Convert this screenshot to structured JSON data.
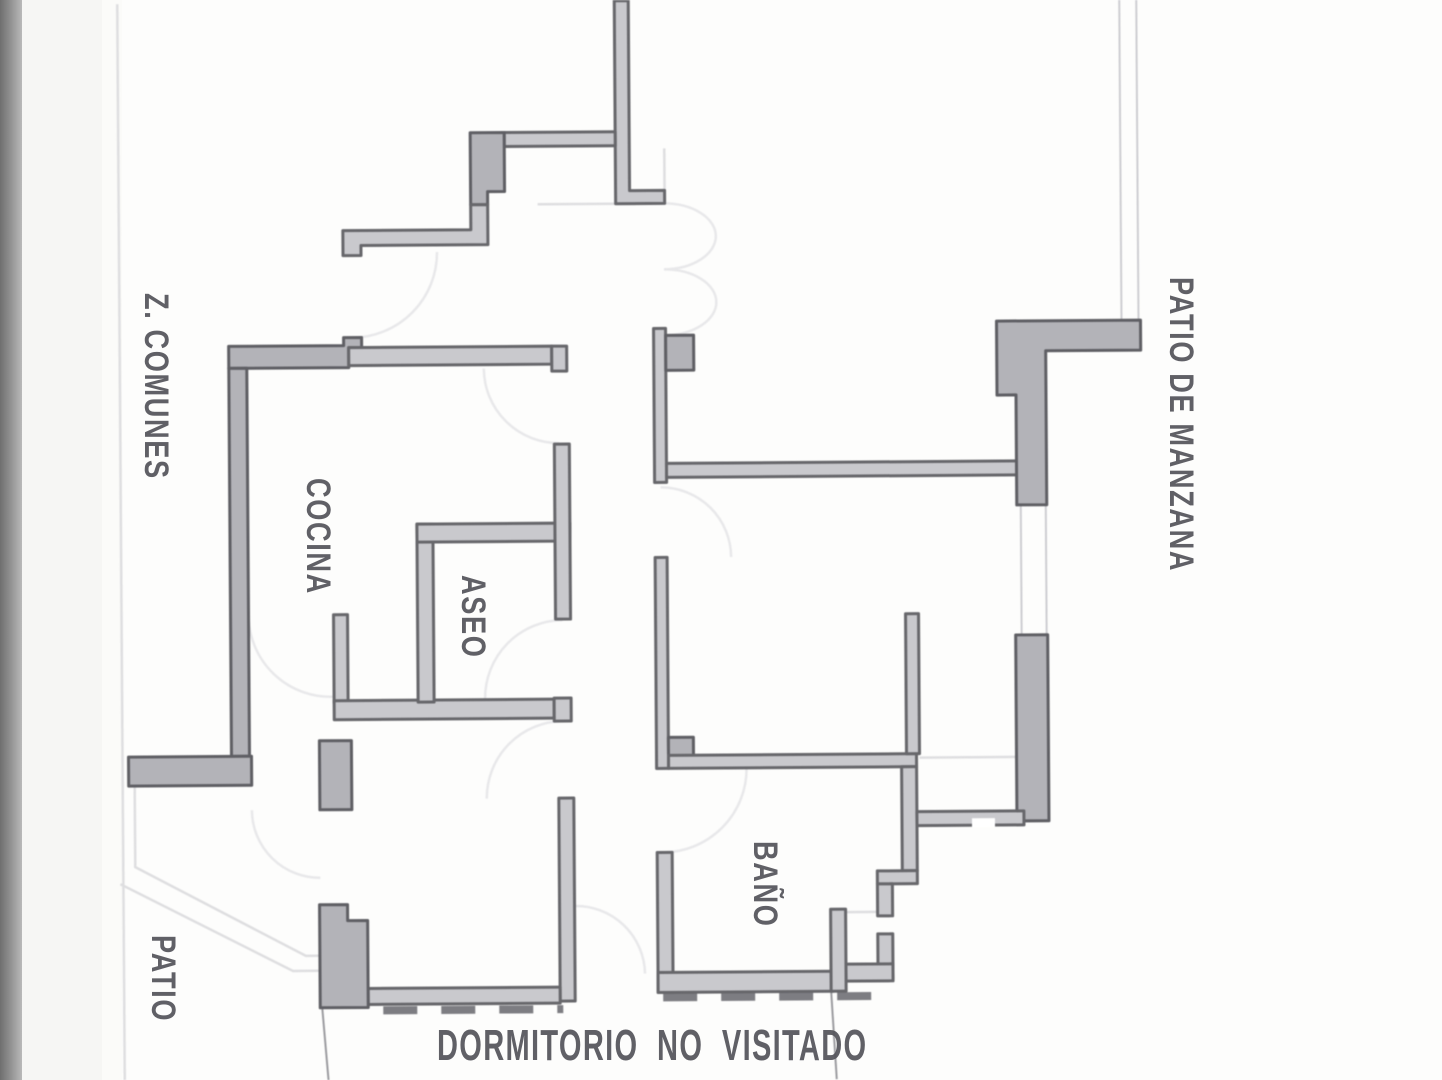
{
  "page": {
    "width": 1442,
    "height": 1080,
    "kind": "scanned architectural floor plan"
  },
  "colors": {
    "paper": "#fdfdfc",
    "scan_strip": "#8a8a8a",
    "wall_fill": "#c9c9cd",
    "wall_thick_fill": "#b3b3b8",
    "wall_stroke": "#67676b",
    "light_line": "#dedee0",
    "door_arc": "#e8e8ea",
    "text": "#53535a"
  },
  "labels": {
    "z_comunes": {
      "text": "Z. COMUNES",
      "x": 175,
      "y": 293,
      "orient": "v"
    },
    "patio_de_manzana": {
      "text": "PATIO DE MANZANA",
      "x": 1200,
      "y": 277,
      "orient": "v"
    },
    "cocina": {
      "text": "COCINA",
      "x": 337,
      "y": 478,
      "orient": "v"
    },
    "aseo": {
      "text": "ASEO",
      "x": 492,
      "y": 575,
      "orient": "v"
    },
    "bano": {
      "text": "BAÑO",
      "x": 784,
      "y": 841,
      "orient": "v"
    },
    "patio": {
      "text": "PATIO",
      "x": 182,
      "y": 935,
      "orient": "v"
    },
    "dormitorio_no_visitado": {
      "text": "DORMITORIO NO VISITADO",
      "x": 437,
      "y": 1021,
      "orient": "h"
    }
  },
  "geometry": {
    "lights": [
      {
        "name": "beam-line-hall-top",
        "d": "M540,203 L660,203"
      },
      {
        "name": "boundary-line-top",
        "d": "M667,148 L667,190"
      },
      {
        "name": "lintel-line-gallery",
        "d": "M918,759 L1018,759"
      },
      {
        "name": "lintel-line-bath-door",
        "d": "M843,913 L875,913"
      },
      {
        "name": "patio-boundary-1",
        "d": "M133,782 L133,863 L303,953 L317,953"
      },
      {
        "name": "patio-boundary-2",
        "d": "M118,880 L290,968 L317,968"
      },
      {
        "name": "page-edge-line",
        "d": "M121,0 L121,1080"
      }
    ],
    "openings": [
      {
        "name": "door-arc-entrance",
        "d": "M439,250 A85,85 0 0 1 354,335"
      },
      {
        "name": "door-arc-double-top",
        "d": "M666,203 A52,33 0 0 1 666,269"
      },
      {
        "name": "door-arc-double-bottom",
        "d": "M666,269 A52,33 0 0 1 666,335"
      },
      {
        "name": "door-arc-kitchen",
        "d": "M485,367 A75,75 0 0 0 560,442"
      },
      {
        "name": "door-arc-kitchen-lower",
        "d": "M248,612 A82,82 0 0 0 333,694"
      },
      {
        "name": "door-arc-hall",
        "d": "M661,487 A70,70 0 0 1 731,557"
      },
      {
        "name": "door-arc-aseo",
        "d": "M562,619 A78,78 0 0 0 484,697"
      },
      {
        "name": "door-arc-dormitorio",
        "d": "M485,797 A77,77 0 0 1 562,720"
      },
      {
        "name": "door-arc-bath-hall",
        "d": "M745,768 A84,84 0 0 1 661,852"
      },
      {
        "name": "door-arc-vestibule",
        "d": "M572,905 A69,69 0 0 1 642,973"
      },
      {
        "name": "door-arc-patio-kitchen",
        "d": "M250,807 A68,68 0 0 0 318,875"
      }
    ],
    "dashes": [
      {
        "name": "dashed-wall-dormitorio-left",
        "d": "M380,1008 L560,1008"
      },
      {
        "name": "dashed-wall-dormitorio-right",
        "d": "M660,997 L888,997"
      }
    ],
    "leaders": [
      {
        "name": "leader-line-left",
        "d": "M319,1005 L325,1080"
      },
      {
        "name": "leader-line-right",
        "d": "M828,992 L833,1080"
      }
    ],
    "windows": [
      {
        "name": "window-right-upper-a",
        "d": "M1021,505 L1021,639"
      },
      {
        "name": "window-right-upper-b",
        "d": "M1046,505 L1046,639"
      },
      {
        "name": "window-top-right-a",
        "d": "M1123,2 L1123,323"
      },
      {
        "name": "window-top-right-b",
        "d": "M1140,2 L1140,323"
      }
    ],
    "walls": [
      {
        "name": "wall-top-vertical",
        "cls": "wl",
        "d": "M618,0 L632,0 L632,190 L667,190 L667,203 L618,203 Z"
      },
      {
        "name": "wall-top-arm",
        "cls": "wl",
        "d": "M507,131 L618,131 L618,145 L507,145 Z"
      },
      {
        "name": "wall-top-pier",
        "cls": "wt",
        "d": "M473,131 L507,131 L507,190 L490,190 L490,203 L473,203 Z"
      },
      {
        "name": "wall-entry-step",
        "cls": "wl",
        "d": "M345,228 L473,228 L473,203 L490,203 L490,243 L363,243 L363,253 L345,253 Z"
      },
      {
        "name": "wall-kitchen-top-thick",
        "cls": "wt",
        "d": "M230,343 L345,343 L345,335 L363,335 L363,345 L350,345 L350,365 L230,365 Z"
      },
      {
        "name": "wall-kitchen-top-arm",
        "cls": "wl",
        "d": "M350,345 L553,345 L553,363 L350,363 Z"
      },
      {
        "name": "wall-kitchen-top-jamb",
        "cls": "wl",
        "d": "M553,345 L568,345 L568,370 L553,370 Z"
      },
      {
        "name": "wall-kitchen-left",
        "cls": "wt",
        "d": "M230,365 L248,365 L248,753 L230,753 Z"
      },
      {
        "name": "wall-zcomunes-bottom",
        "cls": "wt",
        "d": "M127,753 L250,753 L250,782 L127,782 Z"
      },
      {
        "name": "wall-kitchen-right",
        "cls": "wl",
        "d": "M333,612 L347,612 L347,700 L333,700 Z"
      },
      {
        "name": "wall-corridor-bottom",
        "cls": "wl",
        "d": "M333,698 L553,698 L553,717 L333,717 Z"
      },
      {
        "name": "wall-corridor-jamb",
        "cls": "wl",
        "d": "M553,697 L570,697 L570,720 L553,720 Z"
      },
      {
        "name": "wall-aseo-left",
        "cls": "wl",
        "d": "M417,522 L433,522 L433,700 L417,700 Z"
      },
      {
        "name": "wall-aseo-top",
        "cls": "wl",
        "d": "M417,522 L570,522 L570,540 L417,540 Z"
      },
      {
        "name": "wall-aseo-right",
        "cls": "wl",
        "d": "M555,443 L570,443 L570,618 L555,618 Z"
      },
      {
        "name": "wall-dormitorio-right",
        "cls": "wl",
        "d": "M557,797 L572,797 L572,1000 L557,1000 Z"
      },
      {
        "name": "wall-dormitorio-bottom",
        "cls": "wl",
        "d": "M365,986 L557,986 L557,1002 L365,1002 Z"
      },
      {
        "name": "wall-hall-left-upper",
        "cls": "wl",
        "d": "M655,328 L667,328 L667,482 L655,482 Z"
      },
      {
        "name": "pier-hall-left-upper",
        "cls": "wt",
        "d": "M667,335 L695,335 L695,370 L667,370 Z"
      },
      {
        "name": "wall-hall-left-mid",
        "cls": "wl",
        "d": "M655,557 L667,557 L667,768 L655,768 Z"
      },
      {
        "name": "pier-hall-left-mid",
        "cls": "wt",
        "d": "M667,737 L692,737 L692,767 L667,767 Z"
      },
      {
        "name": "wall-bath-top",
        "cls": "wl",
        "d": "M667,755 L915,755 L915,768 L667,768 Z"
      },
      {
        "name": "wall-bath-right",
        "cls": "wl",
        "d": "M900,768 L915,768 L915,872 L900,872 Z"
      },
      {
        "name": "wall-bath-right-step",
        "cls": "wl",
        "d": "M875,872 L915,872 L915,885 L875,885 Z"
      },
      {
        "name": "wall-bath-right-lower-a",
        "cls": "wl",
        "d": "M875,885 L890,885 L890,917 L875,917 Z"
      },
      {
        "name": "wall-bath-right-lower-b",
        "cls": "wl",
        "d": "M875,935 L890,935 L890,980 L875,980 Z"
      },
      {
        "name": "wall-bath-bottom-right",
        "cls": "wl",
        "d": "M843,965 L890,965 L890,982 L843,982 Z"
      },
      {
        "name": "wall-vestibule-left",
        "cls": "wl",
        "d": "M655,852 L670,852 L670,992 L655,992 Z"
      },
      {
        "name": "wall-bath-bottom",
        "cls": "wl",
        "d": "M655,972 L830,972 L830,992 L655,992 Z"
      },
      {
        "name": "wall-bath-door-jamb",
        "cls": "wl",
        "d": "M828,910 L843,910 L843,992 L828,992 Z"
      },
      {
        "name": "wall-living-top",
        "cls": "wl",
        "d": "M667,463 L1022,463 L1022,477 L667,477 Z"
      },
      {
        "name": "wall-gallery-mid",
        "cls": "wl",
        "d": "M905,615 L918,615 L918,755 L905,755 Z"
      },
      {
        "name": "wall-right-upper-thick",
        "cls": "wt",
        "d": "M998,323 L1142,323 L1142,353 L1047,353 L1047,507 L1017,507 L1017,397 L998,397 Z"
      },
      {
        "name": "wall-right-lower-thick",
        "cls": "wt",
        "d": "M1015,637 L1047,637 L1047,823 L1015,823 Z"
      },
      {
        "name": "wall-gallery-bottom",
        "cls": "wl",
        "d": "M915,813 L1022,813 L1022,827 L915,827 Z"
      },
      {
        "name": "pier-kitchen-patio-door",
        "cls": "wt",
        "d": "M318,738 L350,738 L350,807 L318,807 Z"
      },
      {
        "name": "pier-patio-corner",
        "cls": "wt",
        "d": "M317,902 L345,902 L345,918 L365,918 L365,1005 L317,1005 Z"
      }
    ],
    "patches": [
      {
        "name": "opening-gallery-bottom",
        "d": "M970,820 L993,820 L993,829 L970,829 Z"
      }
    ]
  }
}
